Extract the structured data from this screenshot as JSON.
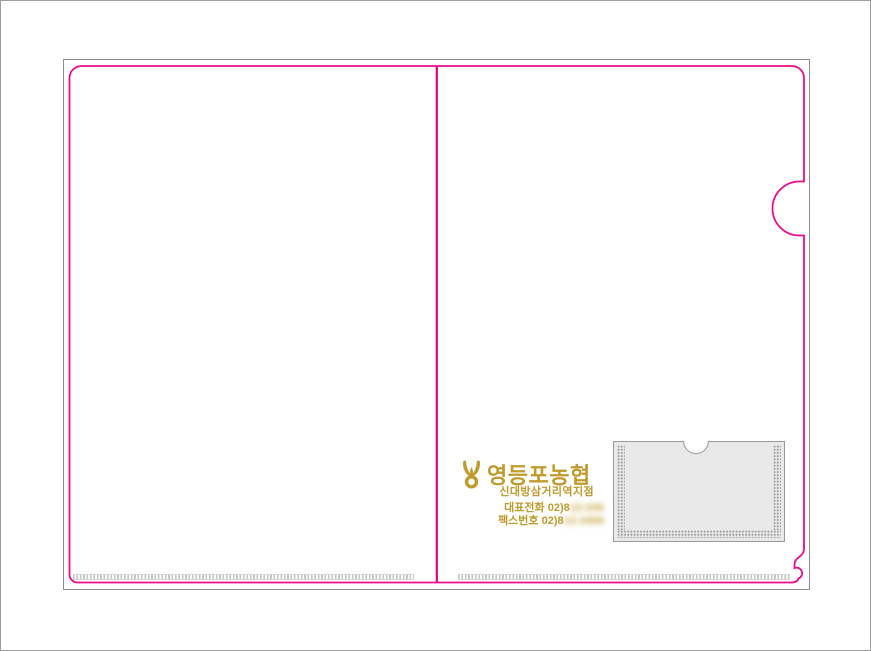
{
  "colors": {
    "die_line": "#EC0C8D",
    "fold_line": "#E2007F",
    "trim_line": "#8C8C8C",
    "page_border": "#9E9E9E",
    "gold": "#C09B2D",
    "pocket_fill": "#E9E9EA",
    "pocket_border": "#9A9A9A",
    "seam_dot": "#9E9E9E",
    "weld_dash": "#C4C4C4"
  },
  "brand": {
    "emblem": "nonghyup-sprout-emblem-icon",
    "name": "영등포농협",
    "branch": "신대방삼거리역지점",
    "phone_visible": "대표전화 02)8",
    "phone_blurred_placeholder": "12-345",
    "fax_visible": "팩스번호 02)8",
    "fax_blurred_placeholder": "12-3456"
  }
}
